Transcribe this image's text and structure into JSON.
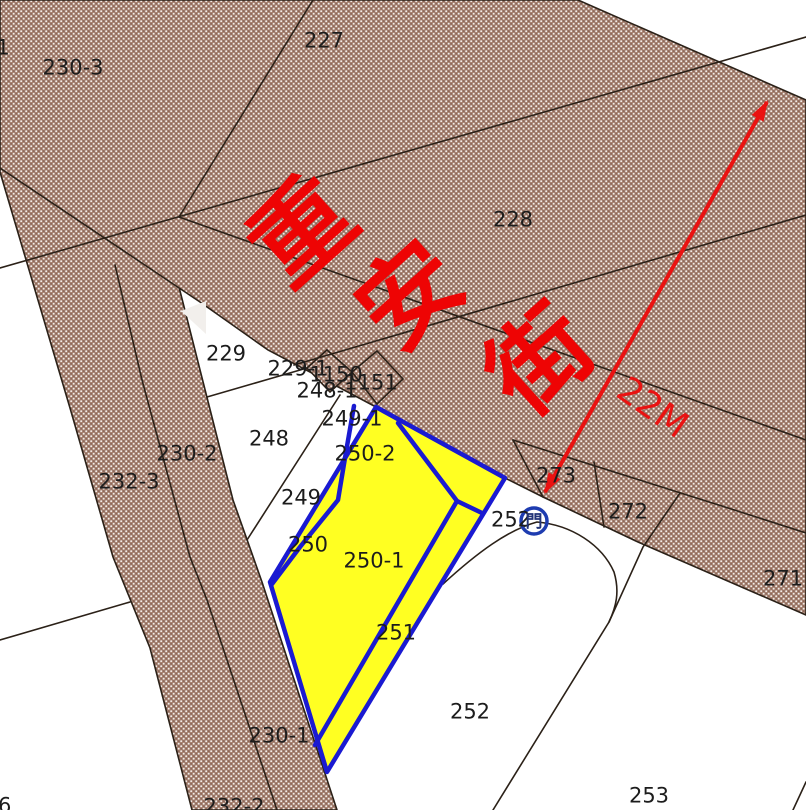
{
  "map": {
    "title": "cadastral-parcel-map",
    "street_name": "重安街",
    "street_rotation": -42,
    "street_font_size": 100,
    "street_chars": [
      {
        "ch": "重",
        "x": 302,
        "y": 231
      },
      {
        "ch": "安",
        "x": 410,
        "y": 295
      },
      {
        "ch": "街",
        "x": 540,
        "y": 360
      }
    ],
    "road_width_label": {
      "text": "22M",
      "x": 653,
      "y": 407,
      "rotation": 35,
      "font_size": 36
    },
    "door_label": {
      "prefix": "252",
      "x": 511,
      "y": 519,
      "char": "門",
      "door_x": 534,
      "door_y": 521
    },
    "parcel_labels": [
      {
        "text": "1",
        "x": 3,
        "y": 47
      },
      {
        "text": "230-3",
        "x": 73,
        "y": 67
      },
      {
        "text": "227",
        "x": 324,
        "y": 40
      },
      {
        "text": "228",
        "x": 513,
        "y": 219
      },
      {
        "text": "229",
        "x": 226,
        "y": 353
      },
      {
        "text": "229-1",
        "x": 298,
        "y": 368
      },
      {
        "text": "1150",
        "x": 336,
        "y": 374
      },
      {
        "text": "1151",
        "x": 371,
        "y": 382
      },
      {
        "text": "248-1",
        "x": 327,
        "y": 390
      },
      {
        "text": "249-1",
        "x": 352,
        "y": 418
      },
      {
        "text": "248",
        "x": 269,
        "y": 438
      },
      {
        "text": "250-2",
        "x": 365,
        "y": 453
      },
      {
        "text": "249",
        "x": 301,
        "y": 497
      },
      {
        "text": "250",
        "x": 308,
        "y": 544
      },
      {
        "text": "250-1",
        "x": 374,
        "y": 560
      },
      {
        "text": "251",
        "x": 396,
        "y": 632
      },
      {
        "text": "230-2",
        "x": 187,
        "y": 453
      },
      {
        "text": "232-3",
        "x": 129,
        "y": 481
      },
      {
        "text": "273",
        "x": 556,
        "y": 475
      },
      {
        "text": "272",
        "x": 628,
        "y": 511
      },
      {
        "text": "271",
        "x": 783,
        "y": 578
      },
      {
        "text": "252",
        "x": 470,
        "y": 711
      },
      {
        "text": "253",
        "x": 649,
        "y": 795
      },
      {
        "text": "230-1",
        "x": 279,
        "y": 735
      },
      {
        "text": "232-2",
        "x": 234,
        "y": 806
      },
      {
        "text": "46",
        "x": -2,
        "y": 805
      }
    ],
    "colors": {
      "road_fill": "#a5816f",
      "road_dot_light": "#ffffff",
      "road_dot_dark": "#8a665a",
      "boundary_line": "#2b2118",
      "highlight_fill": "#ffff22",
      "highlight_border": "#1a1ad1",
      "annotation_red": "#ea1211",
      "street_red": "#ee0404",
      "label_color": "#1c1c1c",
      "door_circle": "#1e3cb0",
      "door_glyph": "#223377"
    }
  }
}
